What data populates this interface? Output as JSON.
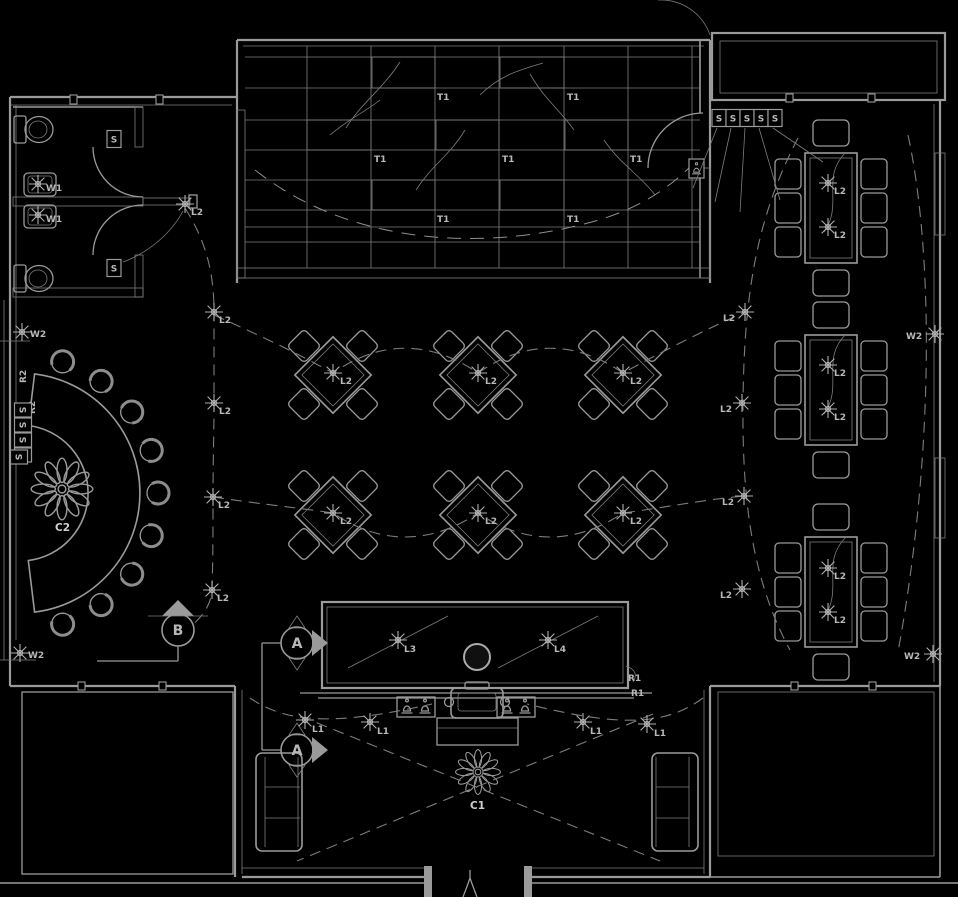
{
  "meta": {
    "drawing_type": "restaurant lighting and furniture floor plan",
    "background": "#000000",
    "line_color": "#9a9a9a",
    "dim_line_color": "#7d7d7d",
    "label_color": "#b8b8b8",
    "bright_color": "#cfcfcf"
  },
  "labels": {
    "t1": "T1",
    "l1": "L1",
    "l2": "L2",
    "l3": "L3",
    "l4": "L4",
    "w1": "W1",
    "w2": "W2",
    "r1": "R1",
    "r2": "R2",
    "c1": "C1",
    "c2": "C2",
    "switch": "S",
    "section_a": "A",
    "section_b": "B"
  },
  "fixtures": [
    {
      "s": 1,
      "k": "w1",
      "x": 38,
      "y": 184,
      "tx": 46,
      "ty": 191
    },
    {
      "s": 1,
      "k": "w1",
      "x": 38,
      "y": 215,
      "tx": 46,
      "ty": 222
    },
    {
      "s": 1,
      "k": "l2",
      "x": 185,
      "y": 204,
      "tx": 191,
      "ty": 215
    },
    {
      "s": 1,
      "k": "l2",
      "x": 214,
      "y": 312,
      "tx": 219,
      "ty": 323
    },
    {
      "s": 1,
      "k": "l2",
      "x": 214,
      "y": 403,
      "tx": 219,
      "ty": 414
    },
    {
      "s": 1,
      "k": "l2",
      "x": 213,
      "y": 497,
      "tx": 218,
      "ty": 508
    },
    {
      "s": 1,
      "k": "l2",
      "x": 212,
      "y": 590,
      "tx": 217,
      "ty": 601
    },
    {
      "s": 1,
      "k": "l2",
      "x": 333,
      "y": 373,
      "tx": 340,
      "ty": 384
    },
    {
      "s": 1,
      "k": "l2",
      "x": 478,
      "y": 373,
      "tx": 485,
      "ty": 384
    },
    {
      "s": 1,
      "k": "l2",
      "x": 623,
      "y": 373,
      "tx": 630,
      "ty": 384
    },
    {
      "s": 1,
      "k": "l2",
      "x": 333,
      "y": 513,
      "tx": 340,
      "ty": 524
    },
    {
      "s": 1,
      "k": "l2",
      "x": 478,
      "y": 513,
      "tx": 485,
      "ty": 524
    },
    {
      "s": 1,
      "k": "l2",
      "x": 623,
      "y": 513,
      "tx": 630,
      "ty": 524
    },
    {
      "s": 1,
      "k": "l2",
      "x": 745,
      "y": 312,
      "tx": 723,
      "ty": 321
    },
    {
      "s": 1,
      "k": "l2",
      "x": 742,
      "y": 403,
      "tx": 720,
      "ty": 412
    },
    {
      "s": 1,
      "k": "l2",
      "x": 744,
      "y": 496,
      "tx": 722,
      "ty": 505
    },
    {
      "s": 1,
      "k": "l2",
      "x": 742,
      "y": 589,
      "tx": 720,
      "ty": 598
    },
    {
      "s": 1,
      "k": "l2",
      "x": 828,
      "y": 183,
      "tx": 834,
      "ty": 194
    },
    {
      "s": 1,
      "k": "l2",
      "x": 828,
      "y": 227,
      "tx": 834,
      "ty": 238
    },
    {
      "s": 1,
      "k": "l2",
      "x": 828,
      "y": 365,
      "tx": 834,
      "ty": 376
    },
    {
      "s": 1,
      "k": "l2",
      "x": 828,
      "y": 409,
      "tx": 834,
      "ty": 420
    },
    {
      "s": 1,
      "k": "l2",
      "x": 828,
      "y": 568,
      "tx": 834,
      "ty": 579
    },
    {
      "s": 1,
      "k": "l2",
      "x": 828,
      "y": 612,
      "tx": 834,
      "ty": 623
    },
    {
      "s": 1,
      "k": "l1",
      "x": 305,
      "y": 720,
      "tx": 312,
      "ty": 732
    },
    {
      "s": 1,
      "k": "l1",
      "x": 370,
      "y": 722,
      "tx": 377,
      "ty": 734
    },
    {
      "s": 1,
      "k": "l1",
      "x": 583,
      "y": 722,
      "tx": 590,
      "ty": 734
    },
    {
      "s": 1,
      "k": "l1",
      "x": 647,
      "y": 724,
      "tx": 654,
      "ty": 736
    },
    {
      "s": 1,
      "k": "l3",
      "x": 398,
      "y": 640,
      "tx": 404,
      "ty": 652
    },
    {
      "s": 1,
      "k": "l4",
      "x": 548,
      "y": 640,
      "tx": 554,
      "ty": 652
    },
    {
      "s": 1,
      "k": "w2",
      "x": 22,
      "y": 332,
      "tx": 30,
      "ty": 337
    },
    {
      "s": 1,
      "k": "w2",
      "x": 20,
      "y": 653,
      "tx": 28,
      "ty": 658
    },
    {
      "s": 1,
      "k": "w2",
      "x": 935,
      "y": 334,
      "tx": 906,
      "ty": 339
    },
    {
      "s": 1,
      "k": "w2",
      "x": 933,
      "y": 654,
      "tx": 904,
      "ty": 659
    },
    {
      "s": 0,
      "k": "t1",
      "tx": 437,
      "ty": 100
    },
    {
      "s": 0,
      "k": "t1",
      "tx": 567,
      "ty": 100
    },
    {
      "s": 0,
      "k": "t1",
      "tx": 374,
      "ty": 162
    },
    {
      "s": 0,
      "k": "t1",
      "tx": 502,
      "ty": 162
    },
    {
      "s": 0,
      "k": "t1",
      "tx": 630,
      "ty": 162
    },
    {
      "s": 0,
      "k": "t1",
      "tx": 437,
      "ty": 222
    },
    {
      "s": 0,
      "k": "t1",
      "tx": 567,
      "ty": 222
    },
    {
      "s": 0,
      "k": "r1",
      "tx": 628,
      "ty": 681
    },
    {
      "s": 0,
      "k": "r1",
      "tx": 631,
      "ty": 696
    },
    {
      "s": 0,
      "k": "r2",
      "tx": 26,
      "ty": 383,
      "r": -90
    },
    {
      "s": 0,
      "k": "r2",
      "tx": 35,
      "ty": 414,
      "r": -90
    },
    {
      "s": 0,
      "k": "c1",
      "tx": 470,
      "ty": 809,
      "b": 1
    },
    {
      "s": 0,
      "k": "c2",
      "tx": 55,
      "ty": 531,
      "b": 1
    }
  ],
  "switches": [
    {
      "x": 114,
      "y": 139
    },
    {
      "x": 114,
      "y": 268
    },
    {
      "x": 719,
      "y": 118
    },
    {
      "x": 733,
      "y": 118
    },
    {
      "x": 747,
      "y": 118
    },
    {
      "x": 761,
      "y": 118
    },
    {
      "x": 775,
      "y": 118
    },
    {
      "x": 23,
      "y": 410,
      "r": 90
    },
    {
      "x": 23,
      "y": 425,
      "r": 90
    },
    {
      "x": 23,
      "y": 440,
      "r": 90
    },
    {
      "x": 23,
      "y": 455,
      "r": 90
    },
    {
      "x": 19,
      "y": 457,
      "r": 90
    }
  ],
  "section_markers": [
    {
      "key": "section_b",
      "x": 178,
      "y": 630
    },
    {
      "key": "section_a",
      "x": 297,
      "y": 643
    },
    {
      "key": "section_a",
      "x": 297,
      "y": 750
    }
  ]
}
